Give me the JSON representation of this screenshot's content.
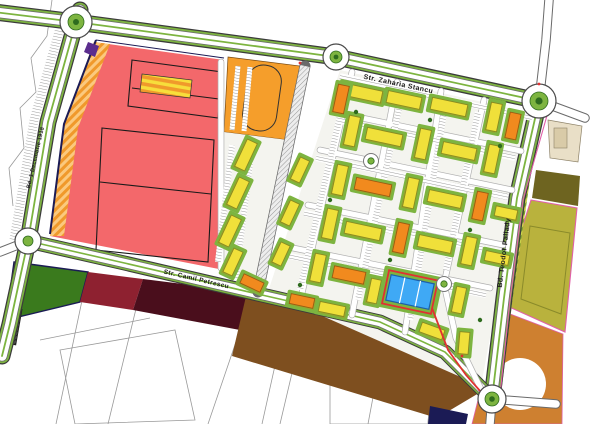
{
  "streets": {
    "zaharia": "Str. Zaharia Stancu",
    "camil": "Str. Camil Petrescu",
    "pallady": "Bd. Teodor Pallady",
    "decembrie": "Bd. 1 Decembrie 1918"
  },
  "colors": {
    "zone_commercial_red": "#F3686B",
    "zone_parking_orange": "#F59E2B",
    "zone_beige": "#E9DFC7",
    "zone_dark_olive": "#6E6420",
    "zone_olive_field": "#B9B23D",
    "zone_brown_se": "#CE8030",
    "zone_brown_south": "#7E4F1F",
    "zone_maroon": "#4A0E1C",
    "zone_crimson": "#8E2130",
    "zone_green_south": "#3A7A1D",
    "lawn": "#7DB440",
    "dark_green": "#2E6B1E",
    "bldg_yellow": "#F0E03A",
    "bldg_yellow_stroke": "#8A8A20",
    "bldg_orange": "#F18A1E",
    "bldg_orange_stroke": "#9C5A10",
    "bldg_shadow": "#93A72F",
    "bldg_blue": "#3FA9F5",
    "bldg_blue_stroke": "#1E5FA8",
    "boundary_pink": "#E060A8",
    "route_red": "#E03131",
    "navy": "#1B1B55"
  },
  "map": {
    "buildings": [
      [
        362,
        93,
        40,
        12,
        12,
        "y"
      ],
      [
        341,
        99,
        28,
        11,
        102,
        "o"
      ],
      [
        404,
        100,
        34,
        12,
        12,
        "y"
      ],
      [
        449,
        107,
        36,
        12,
        12,
        "y"
      ],
      [
        494,
        117,
        28,
        11,
        102,
        "y"
      ],
      [
        513,
        126,
        26,
        11,
        102,
        "o"
      ],
      [
        352,
        131,
        30,
        11,
        102,
        "y"
      ],
      [
        384,
        137,
        36,
        12,
        12,
        "y"
      ],
      [
        423,
        144,
        30,
        11,
        102,
        "y"
      ],
      [
        459,
        151,
        34,
        12,
        12,
        "y"
      ],
      [
        492,
        159,
        28,
        11,
        102,
        "y"
      ],
      [
        340,
        180,
        30,
        11,
        102,
        "y"
      ],
      [
        373,
        187,
        36,
        12,
        12,
        "o"
      ],
      [
        411,
        193,
        30,
        11,
        102,
        "y"
      ],
      [
        445,
        199,
        34,
        12,
        12,
        "y"
      ],
      [
        480,
        206,
        28,
        11,
        102,
        "o"
      ],
      [
        506,
        213,
        22,
        10,
        12,
        "y"
      ],
      [
        330,
        224,
        30,
        11,
        102,
        "y"
      ],
      [
        363,
        231,
        36,
        12,
        12,
        "y"
      ],
      [
        401,
        238,
        30,
        11,
        102,
        "o"
      ],
      [
        435,
        244,
        34,
        12,
        12,
        "y"
      ],
      [
        469,
        251,
        28,
        11,
        102,
        "y"
      ],
      [
        497,
        258,
        24,
        10,
        12,
        "y"
      ],
      [
        318,
        268,
        28,
        11,
        102,
        "y"
      ],
      [
        349,
        275,
        32,
        12,
        12,
        "o"
      ],
      [
        374,
        291,
        24,
        10,
        102,
        "y"
      ],
      [
        459,
        300,
        26,
        10,
        102,
        "y"
      ],
      [
        302,
        301,
        24,
        10,
        12,
        "o"
      ],
      [
        332,
        309,
        26,
        10,
        12,
        "y"
      ],
      [
        432,
        331,
        24,
        10,
        20,
        "y"
      ],
      [
        464,
        343,
        22,
        10,
        95,
        "y"
      ],
      [
        246,
        155,
        30,
        11,
        115,
        "y"
      ],
      [
        238,
        193,
        30,
        11,
        115,
        "y"
      ],
      [
        230,
        231,
        30,
        11,
        115,
        "y"
      ],
      [
        233,
        262,
        26,
        10,
        115,
        "y"
      ],
      [
        252,
        283,
        22,
        10,
        25,
        "o"
      ],
      [
        300,
        170,
        24,
        10,
        115,
        "y"
      ],
      [
        290,
        213,
        24,
        10,
        115,
        "y"
      ],
      [
        281,
        254,
        22,
        10,
        115,
        "y"
      ]
    ]
  }
}
